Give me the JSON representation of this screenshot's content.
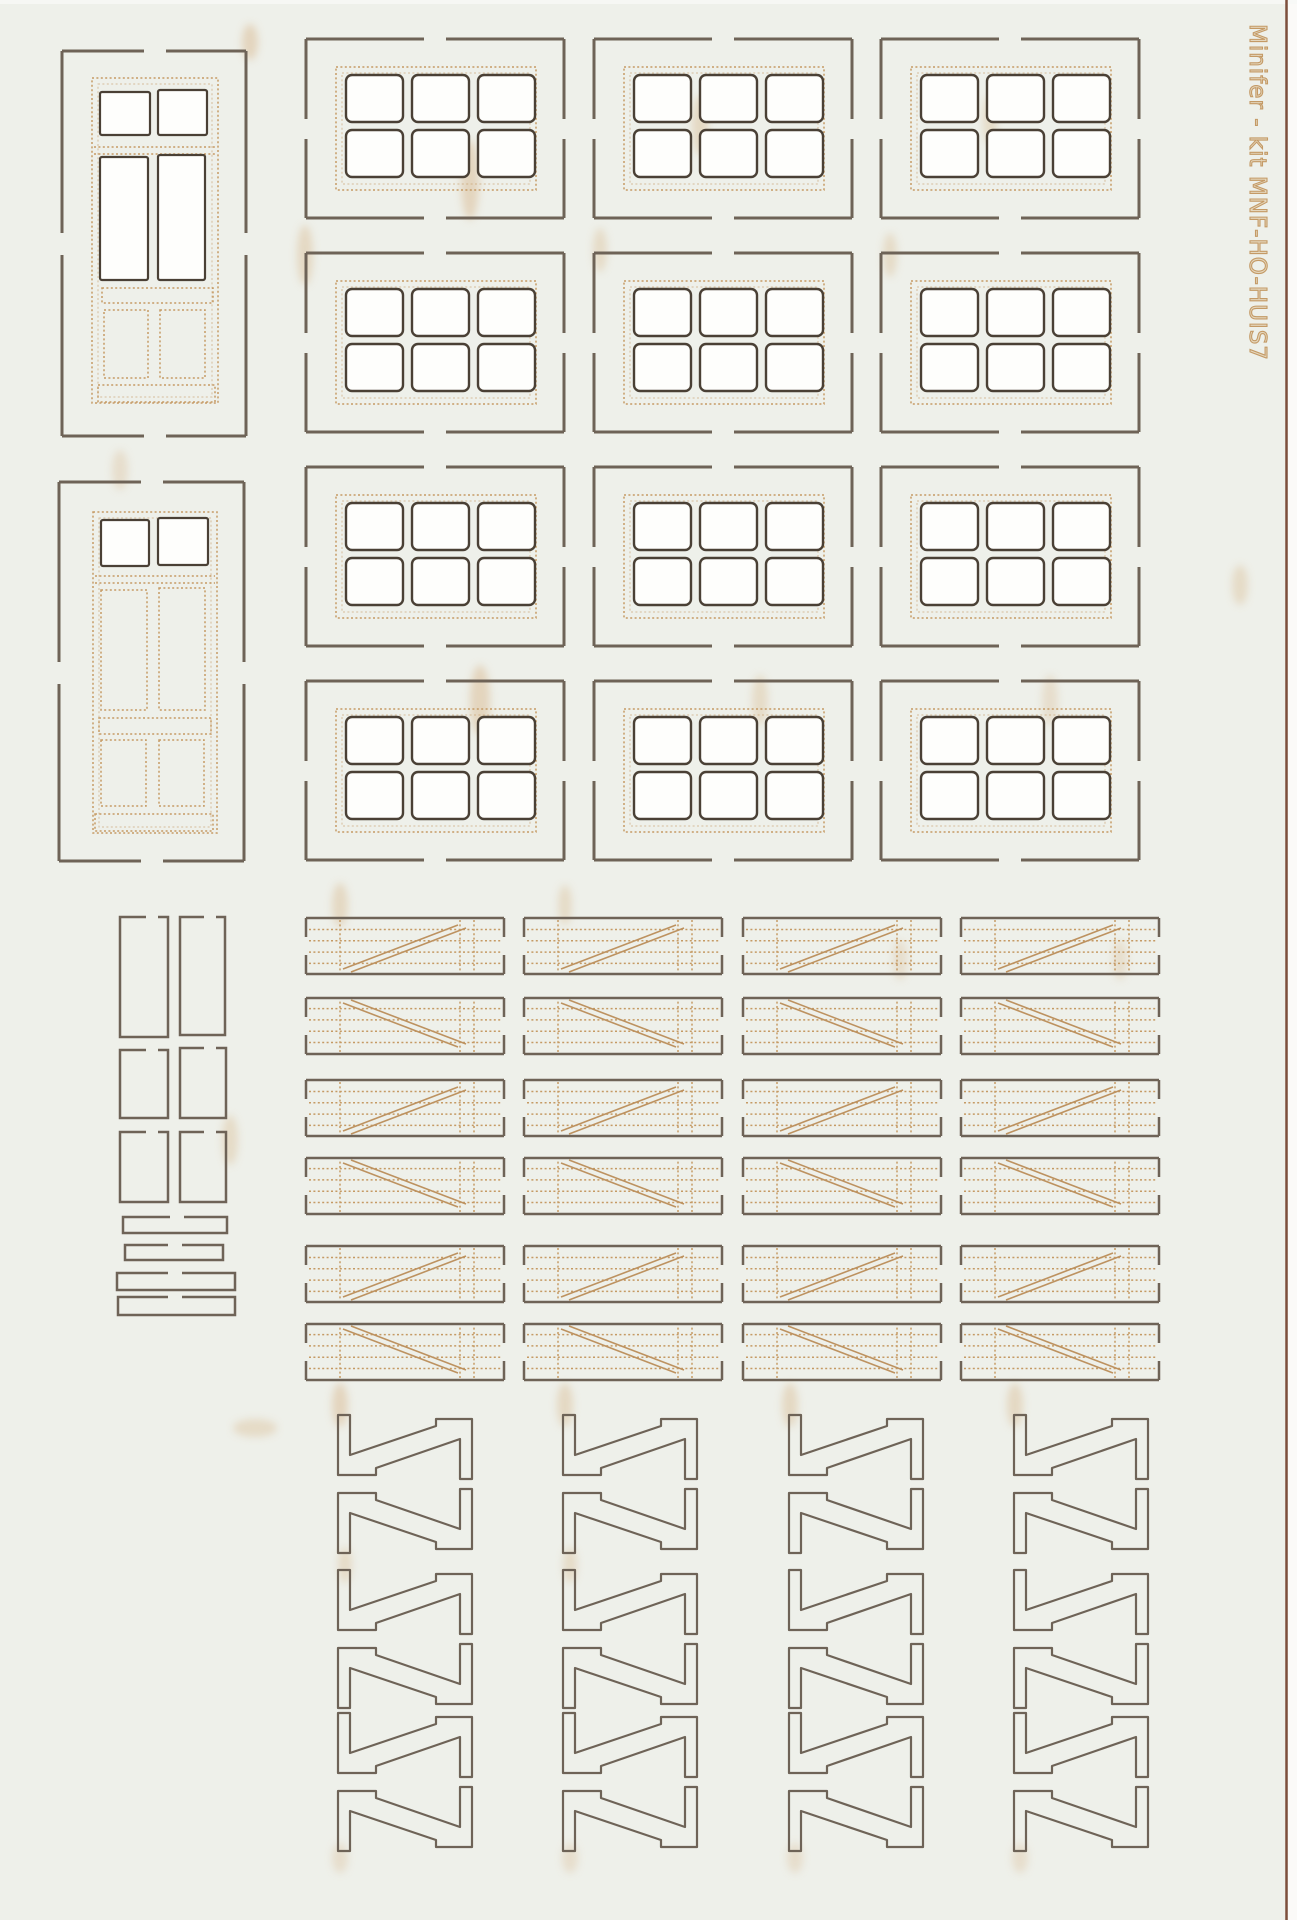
{
  "sheet": {
    "label": "Minifer - kit MNF-HO-HUIS7",
    "description": "scan of a laser-cut card kit sheet with doors, six-pane windows, planked shutters and Z-braces"
  },
  "colors": {
    "paper": "#eef0ea",
    "cut_line": "#6e6357",
    "pane_cut_line": "#4a4035",
    "engrave_line": "#c59a64",
    "scorch": "#d8b488",
    "label_text": "#c49a66",
    "sheet_edge_line": "#7d4f3c",
    "outside_sheet": "#fbfaf8"
  },
  "parts": {
    "doors": {
      "count": 2,
      "name": "panel-door-with-transom"
    },
    "windows": {
      "count": 12,
      "grid": {
        "rows": 4,
        "cols": 3
      },
      "panes_per_window": 6,
      "name": "six-pane-window"
    },
    "shutters": {
      "count": 24,
      "grid": {
        "rows": 6,
        "cols": 4
      },
      "name": "planked-shutter-with-diagonal-brace"
    },
    "braces": {
      "count": 24,
      "grid": {
        "rows": 6,
        "cols": 4
      },
      "name": "z-brace"
    },
    "small_frames": {
      "count": 6,
      "name": "rectangular-frame-strip"
    },
    "strips": {
      "count": 4,
      "name": "flat-strip"
    }
  }
}
